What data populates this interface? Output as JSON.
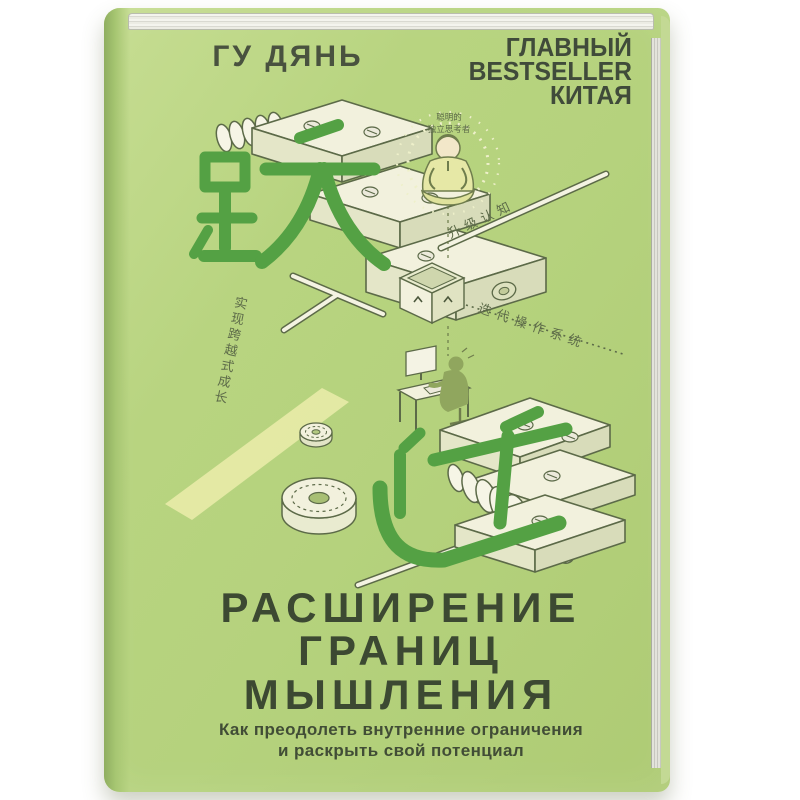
{
  "page": {
    "background": "#ffffff"
  },
  "book": {
    "author": "ГУ ДЯНЬ",
    "badge_lines": [
      "ГЛАВНЫЙ",
      "BESTSELLER",
      "КИТАЯ"
    ],
    "title_lines": [
      "РАСШИРЕНИЕ",
      "ГРАНИЦ",
      "МЫШЛЕНИЯ"
    ],
    "subtitle_lines": [
      "Как преодолеть внутренние ограничения",
      "и раскрыть свой потенциал"
    ],
    "cover_art": {
      "character_top": "跃",
      "character_bottom": "迁",
      "label_thinker_line1": "聪明的",
      "label_thinker_line2": "独立思考者",
      "label_upgrade": "升级认知",
      "label_iterate": "迭代操作系统",
      "label_growth": "实现跨越式成长"
    },
    "colors": {
      "cover_green": "#b5d27d",
      "character_green": "#54a144",
      "ink_dark": "#3d4933",
      "line_olive": "#5c6a48",
      "shape_cream": "#f2f1dd",
      "accent_band_yellow": "#e6eaa6",
      "page_edge_grey": "#d9d9d1"
    }
  }
}
